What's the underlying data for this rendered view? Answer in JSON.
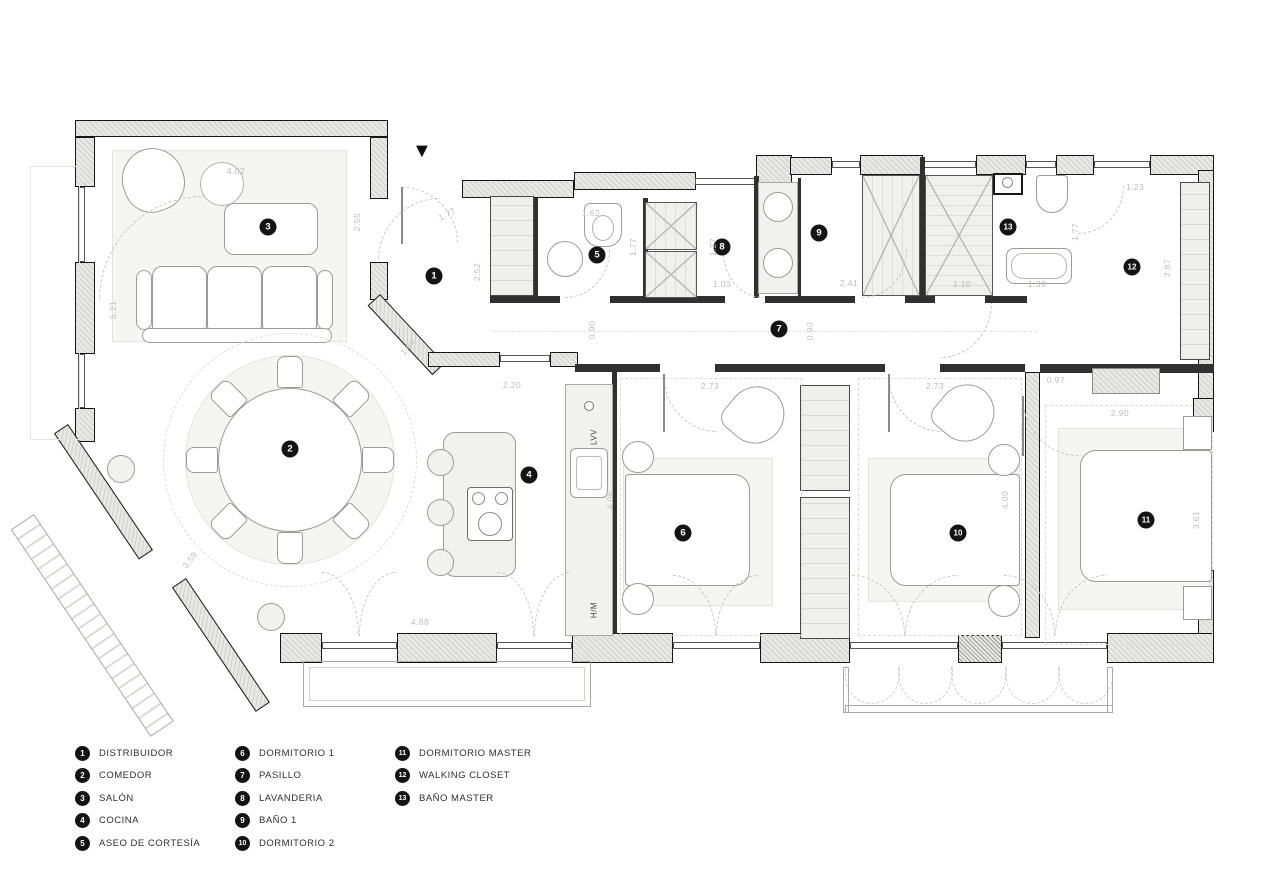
{
  "plan": {
    "entrance_marker": "▼",
    "room_badges": [
      {
        "num": "1",
        "x": 434,
        "y": 276
      },
      {
        "num": "2",
        "x": 290,
        "y": 449
      },
      {
        "num": "3",
        "x": 268,
        "y": 227
      },
      {
        "num": "4",
        "x": 529,
        "y": 475
      },
      {
        "num": "5",
        "x": 597,
        "y": 255
      },
      {
        "num": "6",
        "x": 683,
        "y": 533
      },
      {
        "num": "7",
        "x": 779,
        "y": 329
      },
      {
        "num": "8",
        "x": 722,
        "y": 247
      },
      {
        "num": "9",
        "x": 819,
        "y": 233
      },
      {
        "num": "10",
        "x": 958,
        "y": 533
      },
      {
        "num": "11",
        "x": 1146,
        "y": 520
      },
      {
        "num": "12",
        "x": 1132,
        "y": 267
      },
      {
        "num": "13",
        "x": 1008,
        "y": 227
      }
    ],
    "dimension_labels": [
      {
        "text": "5.21",
        "x": 113,
        "y": 310,
        "rot": -90
      },
      {
        "text": "4.02",
        "x": 236,
        "y": 171,
        "rot": 0
      },
      {
        "text": "2.55",
        "x": 357,
        "y": 222,
        "rot": -90
      },
      {
        "text": "1.77",
        "x": 447,
        "y": 214,
        "rot": -28
      },
      {
        "text": "2.52",
        "x": 477,
        "y": 272,
        "rot": -90
      },
      {
        "text": "1.64",
        "x": 408,
        "y": 347,
        "rot": -50
      },
      {
        "text": "2.20",
        "x": 512,
        "y": 385,
        "rot": 0
      },
      {
        "text": "1.62",
        "x": 591,
        "y": 213,
        "rot": 0
      },
      {
        "text": "1.77",
        "x": 633,
        "y": 247,
        "rot": -90
      },
      {
        "text": "0.90",
        "x": 592,
        "y": 330,
        "rot": -90
      },
      {
        "text": "1.27",
        "x": 713,
        "y": 247,
        "rot": -90
      },
      {
        "text": "1.03",
        "x": 722,
        "y": 284,
        "rot": 0
      },
      {
        "text": "2.41",
        "x": 849,
        "y": 283,
        "rot": 0
      },
      {
        "text": "0.90",
        "x": 810,
        "y": 331,
        "rot": -90
      },
      {
        "text": "1.10",
        "x": 962,
        "y": 284,
        "rot": 0
      },
      {
        "text": "1.39",
        "x": 1037,
        "y": 284,
        "rot": 0
      },
      {
        "text": "1.77",
        "x": 1075,
        "y": 232,
        "rot": -90
      },
      {
        "text": "1.23",
        "x": 1135,
        "y": 187,
        "rot": 0
      },
      {
        "text": "2.87",
        "x": 1167,
        "y": 268,
        "rot": -90
      },
      {
        "text": "0.97",
        "x": 1056,
        "y": 380,
        "rot": 0
      },
      {
        "text": "2.90",
        "x": 1120,
        "y": 413,
        "rot": 0
      },
      {
        "text": "3.61",
        "x": 1196,
        "y": 520,
        "rot": -90
      },
      {
        "text": "2.73",
        "x": 710,
        "y": 386,
        "rot": 0
      },
      {
        "text": "2.73",
        "x": 935,
        "y": 386,
        "rot": 0
      },
      {
        "text": "4.06",
        "x": 610,
        "y": 500,
        "rot": -90
      },
      {
        "text": "4.00",
        "x": 1005,
        "y": 500,
        "rot": -90
      },
      {
        "text": "4.88",
        "x": 420,
        "y": 622,
        "rot": 0
      },
      {
        "text": "3.59",
        "x": 190,
        "y": 560,
        "rot": -52
      }
    ],
    "fixture_labels": [
      {
        "text": "LVV",
        "x": 594,
        "y": 437,
        "rot": -90
      },
      {
        "text": "H/M",
        "x": 594,
        "y": 610,
        "rot": -90
      }
    ]
  },
  "legend": {
    "items": [
      {
        "num": "1",
        "label": "DISTRIBUIDOR",
        "col": 0
      },
      {
        "num": "2",
        "label": "COMEDOR",
        "col": 0
      },
      {
        "num": "3",
        "label": "SALÓN",
        "col": 0
      },
      {
        "num": "4",
        "label": "COCINA",
        "col": 0
      },
      {
        "num": "5",
        "label": "ASEO DE CORTESÍA",
        "col": 0
      },
      {
        "num": "6",
        "label": "DORMITORIO 1",
        "col": 1
      },
      {
        "num": "7",
        "label": "PASILLO",
        "col": 1
      },
      {
        "num": "8",
        "label": "LAVANDERIA",
        "col": 1
      },
      {
        "num": "9",
        "label": "BAÑO 1",
        "col": 1
      },
      {
        "num": "10",
        "label": "DORMITORIO 2",
        "col": 1
      },
      {
        "num": "11",
        "label": "DORMITORIO MASTER",
        "col": 2
      },
      {
        "num": "12",
        "label": "WALKING CLOSET",
        "col": 2
      },
      {
        "num": "13",
        "label": "BAÑO MASTER",
        "col": 2
      }
    ]
  }
}
